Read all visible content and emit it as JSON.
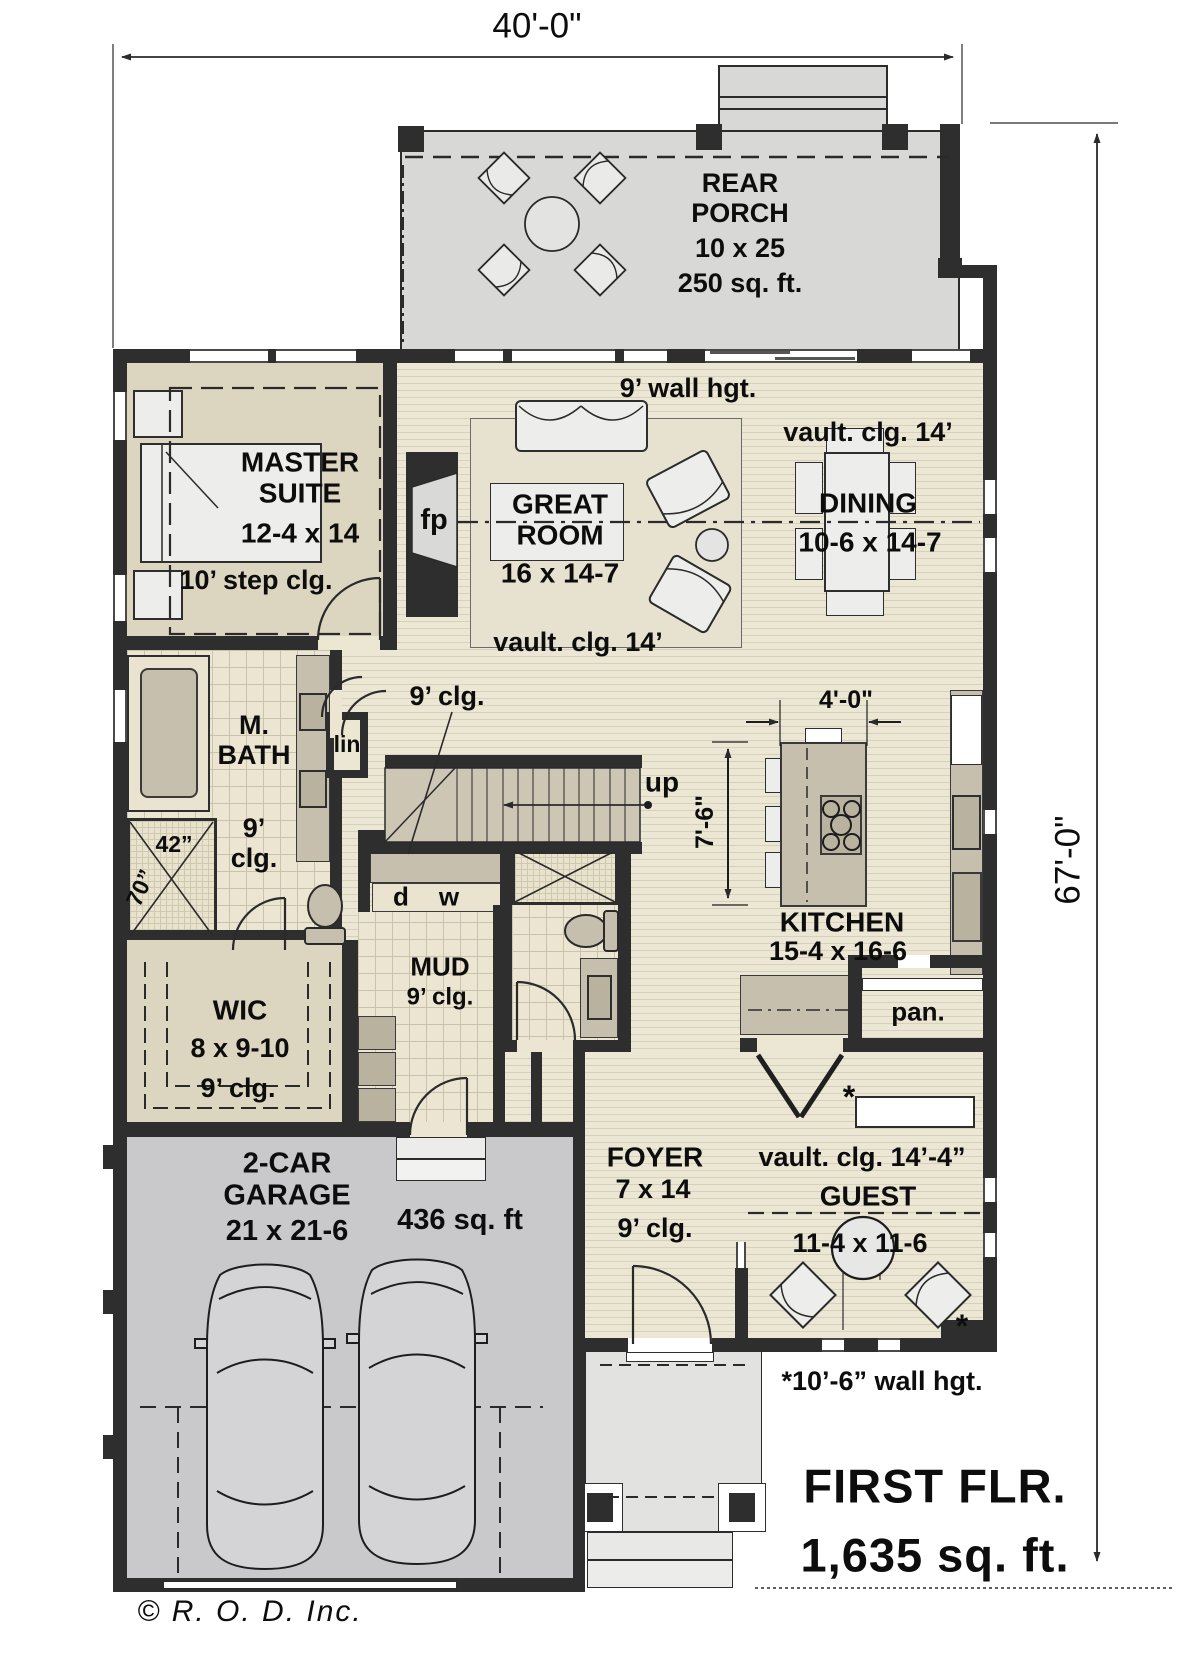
{
  "plan": {
    "sheet": {
      "floor_title": "FIRST FLR.",
      "floor_area": "1,635 sq. ft.",
      "wall_note": "*10’-6” wall hgt.",
      "copyright": "© R. O. D.  Inc."
    },
    "dimensions": {
      "overall_width": "40'-0\"",
      "overall_depth": "67'-0\"",
      "island_width": "4'-0\"",
      "island_depth": "7'-6\"",
      "shower_width": "42”",
      "shower_depth": "70”"
    },
    "rooms": {
      "rear_porch": {
        "name": "REAR PORCH",
        "size": "10 x 25",
        "area": "250 sq. ft."
      },
      "master": {
        "name": "MASTER SUITE",
        "size": "12-4 x 14",
        "ceiling": "10’ step clg."
      },
      "great_room": {
        "name": "GREAT ROOM",
        "size": "16 x 14-7",
        "ceiling": "vault. clg. 14’",
        "wall_height": "9’ wall hgt."
      },
      "dining": {
        "name": "DINING",
        "size": "10-6 x 14-7",
        "ceiling": "vault. clg. 14’"
      },
      "kitchen": {
        "name": "KITCHEN",
        "size": "15-4 x 16-6"
      },
      "pantry": {
        "label": "pan."
      },
      "master_bath": {
        "name": "M. BATH",
        "ceiling": "9’ clg."
      },
      "wic": {
        "name": "WIC",
        "size": "8 x 9-10",
        "ceiling": "9’ clg."
      },
      "mud": {
        "name": "MUD",
        "ceiling": "9’ clg."
      },
      "hall": {
        "ceiling": "9’ clg."
      },
      "foyer": {
        "name": "FOYER",
        "size": "7 x 14",
        "ceiling": "9’ clg."
      },
      "guest": {
        "name": "GUEST",
        "size": "11-4 x 11-6",
        "ceiling": "vault. clg. 14’-4”",
        "note": "*"
      },
      "garage": {
        "name": "2-CAR GARAGE",
        "size": "21 x 21-6",
        "area": "436 sq. ft"
      },
      "linen": {
        "label": "lin"
      },
      "stairs": {
        "label": "up"
      },
      "laundry": {
        "dryer": "d",
        "washer": "w"
      },
      "fireplace": {
        "label": "fp"
      }
    }
  }
}
